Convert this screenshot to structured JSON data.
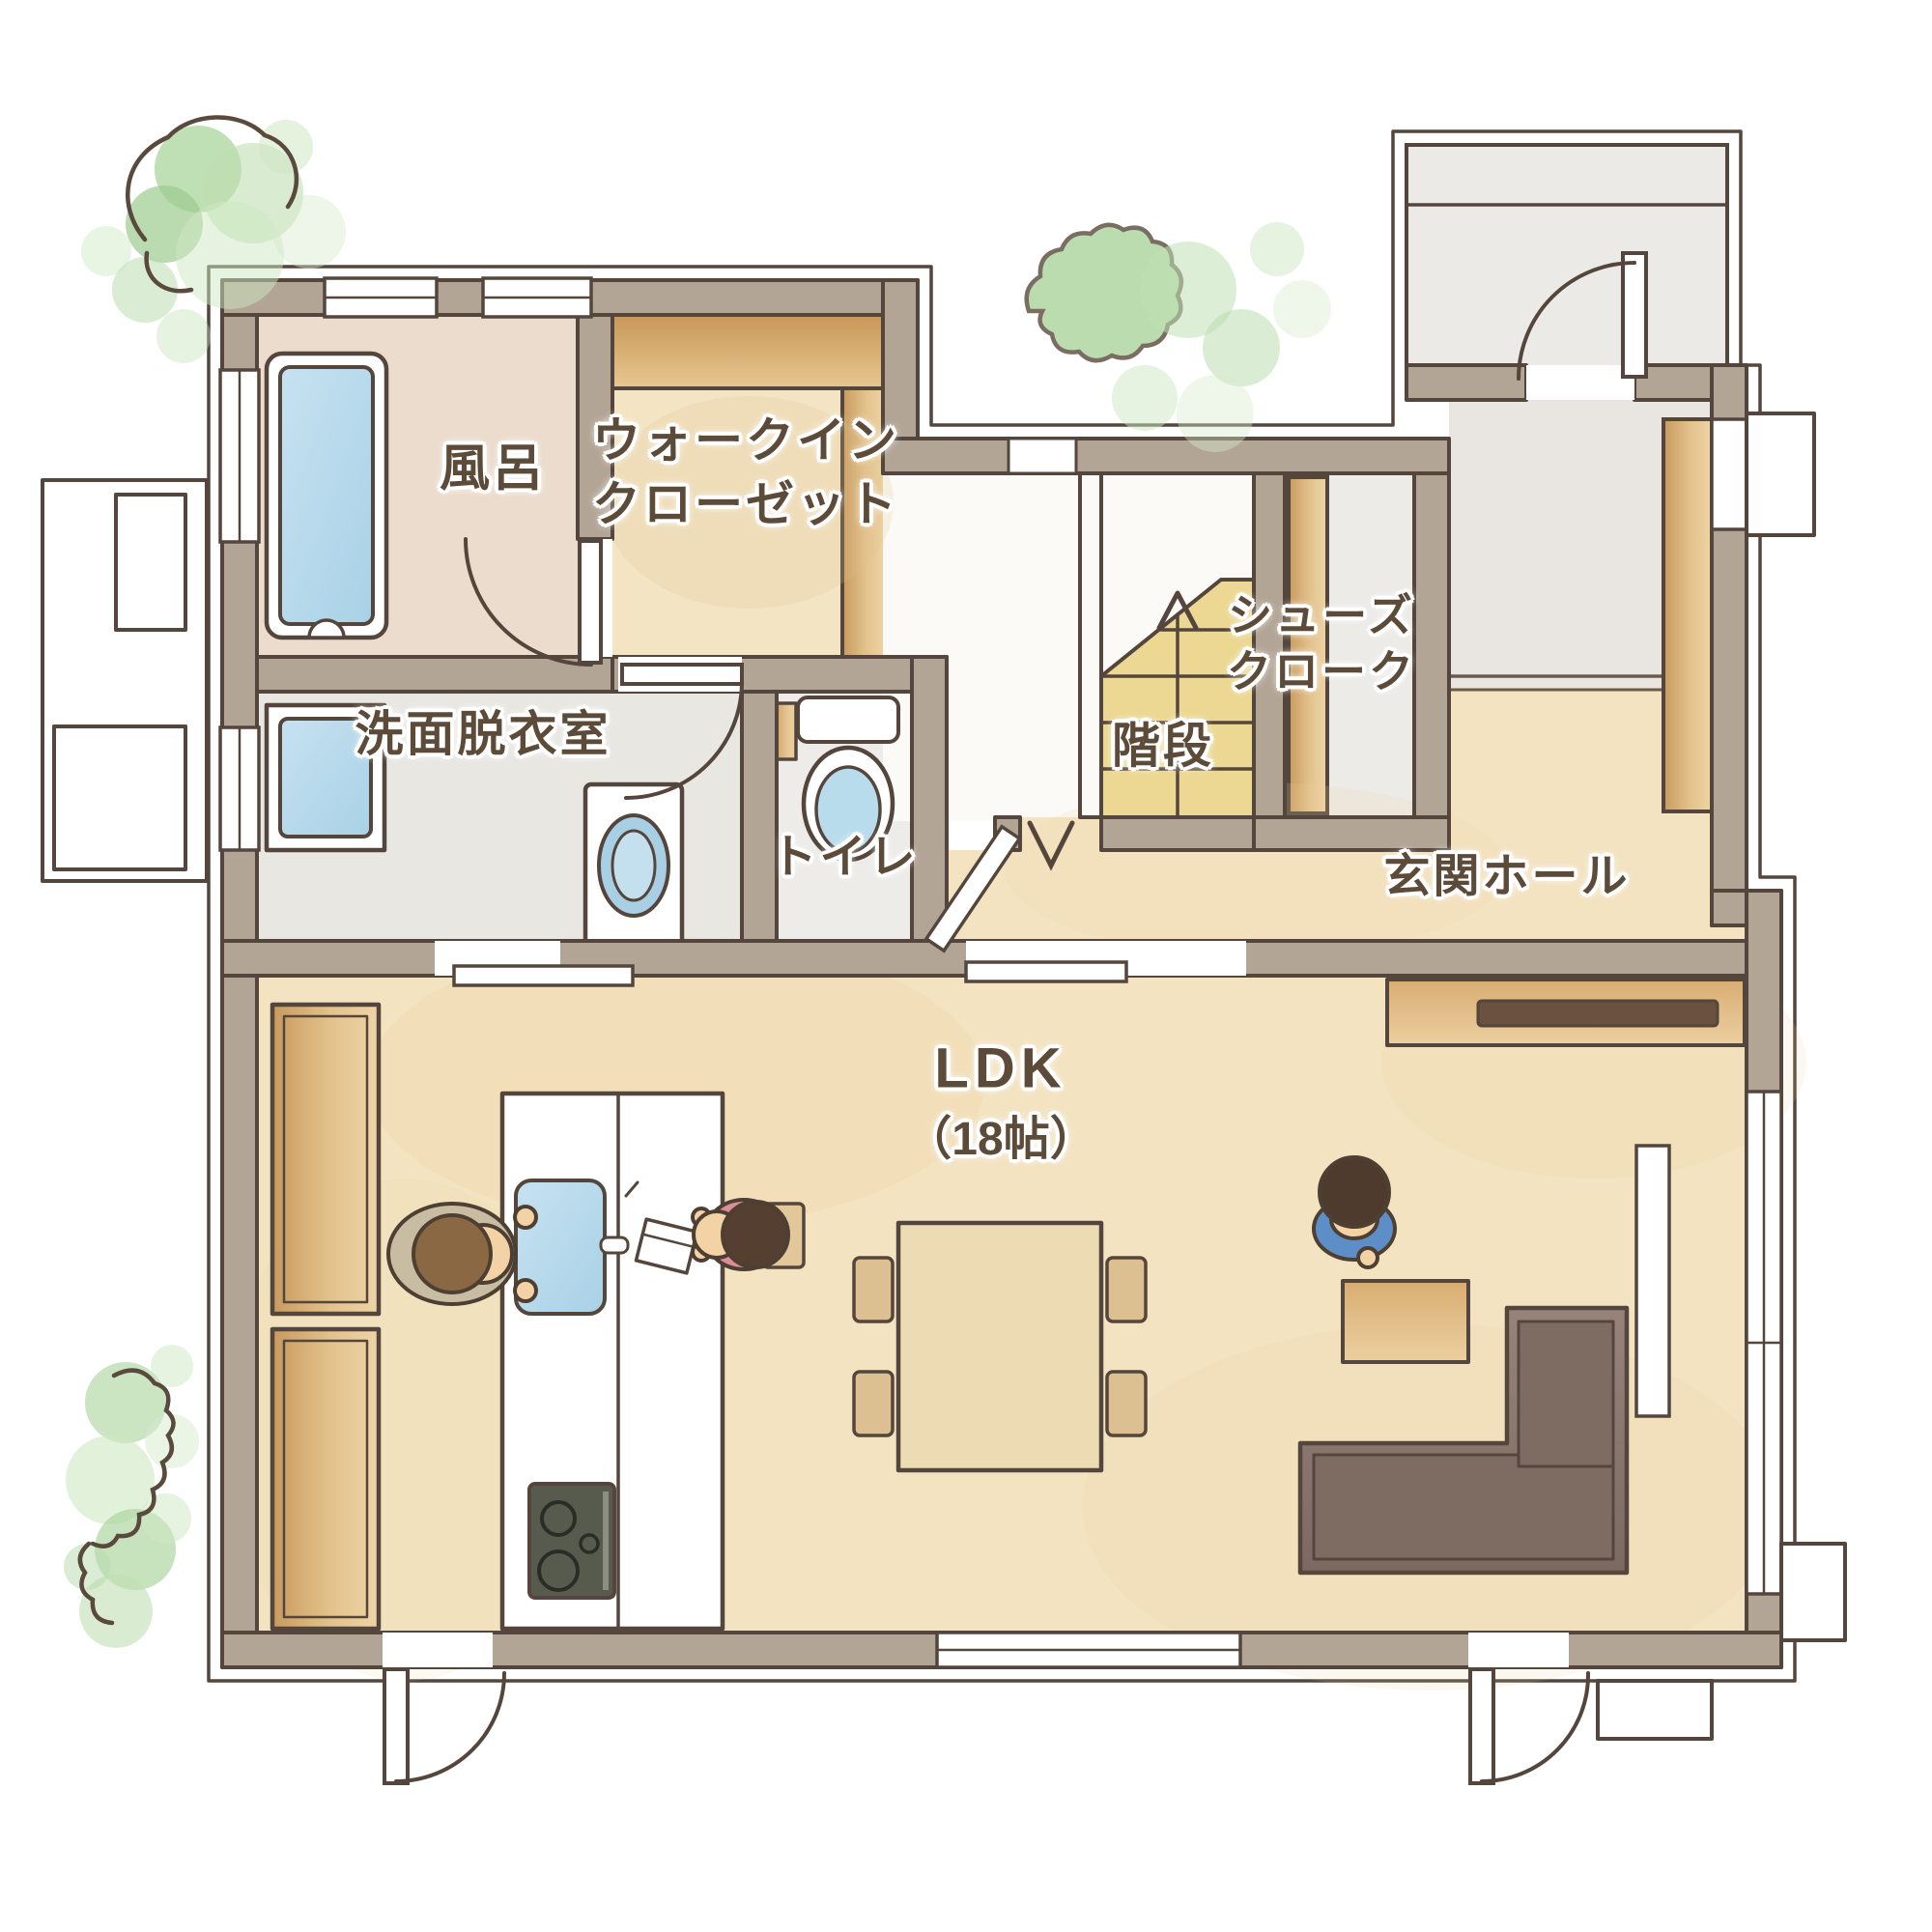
{
  "rooms": {
    "bath": "風呂",
    "walk_in_closet": [
      "ウォークイン",
      "クローゼット"
    ],
    "washroom": "洗面脱衣室",
    "toilet": "トイレ",
    "stairs": "階段",
    "shoe_cloak": [
      "シューズ",
      "クローク"
    ],
    "entrance_hall": "玄関ホール",
    "ldk": {
      "name": "LDK",
      "size": "（18帖）"
    }
  },
  "colors": {
    "wall": "#b3a596",
    "outline": "#54463c",
    "wood_floor": "#f4e3c1",
    "grey_floor": "#e9e7e2",
    "bath_floor": "#ecdccd",
    "closet_shelf": "#cfa265",
    "stairs_yellow": "#ecd892",
    "water_blue": "#b4d8eb",
    "sofa_brown": "#8d7b72",
    "tv_bar_brown": "#6b5140",
    "greenery_green": "#b5d9a8",
    "label_text": "#5d4b3a",
    "shirt_parent": "#c8bca3",
    "shirt_child_pink": "#dd8d9a",
    "shirt_child_blue": "#5d8ec7"
  }
}
